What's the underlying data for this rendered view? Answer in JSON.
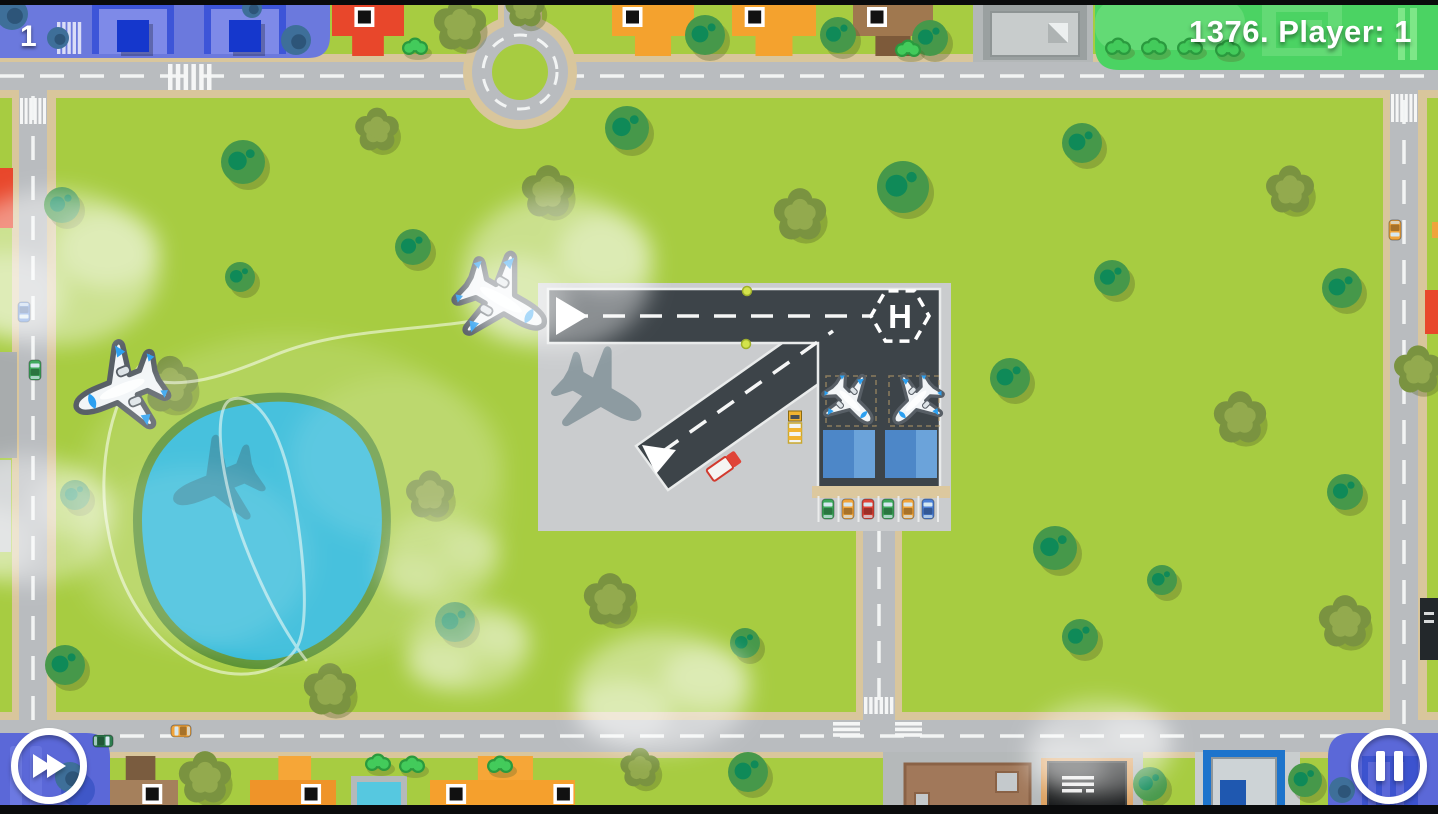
{
  "hud": {
    "level": "1",
    "score_text": "1376. Player: 1",
    "fast_forward_label": "Fast forward",
    "pause_label": "Pause"
  },
  "airport": {
    "helipad_letter": "H"
  },
  "palette": {
    "grass": "#a7cc41",
    "park_green": "#4bd363",
    "road": "#b9bcbf",
    "road_edge": "#d9c69c",
    "runway": "#3d4449",
    "apron": "#caccce",
    "lake": "#29b7d7",
    "lake_edge": "#578f2e",
    "blue_zone": "#6b79dd",
    "panel_blue": "#5b68d8",
    "hangar": "#4d87c8",
    "hangar_light": "#6ba3da",
    "tree_green": "#46984a",
    "tree_blob": "#0f8a58",
    "olive": "#7a9340",
    "olive_light": "#93aa4e",
    "bush_dark": "#2a9a3e",
    "bush_light": "#43cb5b",
    "teal_tree": "#3e6f99",
    "teal_blob": "#2d5579",
    "plane_body": "#f2f5f7",
    "plane_accent": "#2b9ff0",
    "plane_outline": "#585f66",
    "hud_text": "#ffffff"
  },
  "scene": {
    "flying_planes": [
      {
        "x": 120,
        "y": 390,
        "rot": 248,
        "scale": 1.2
      },
      {
        "x": 503,
        "y": 301,
        "rot": 120,
        "scale": 1.2
      }
    ],
    "parked_planes": [
      {
        "x": 851,
        "y": 402,
        "rot": 135,
        "scale": 0.72
      },
      {
        "x": 915,
        "y": 402,
        "rot": 225,
        "scale": 0.72
      }
    ],
    "shadow_offset": {
      "dx": 97,
      "dy": 93
    },
    "flight_paths": [
      "M 505,315 C 430,332 345,326 275,355 C 232,373 196,386 162,382",
      "M 150,355 C 110,390 96,470 108,530 C 118,590 150,640 195,663 C 240,685 285,672 298,645 C 312,615 300,520 288,470 C 272,410 248,392 230,400 C 212,410 220,480 245,545 C 268,605 292,642 306,660"
    ],
    "waypoint_dots": [
      {
        "x": 747,
        "y": 291
      },
      {
        "x": 746,
        "y": 344
      }
    ],
    "trees": [
      {
        "t": "A",
        "x": 243,
        "y": 162,
        "r": 22
      },
      {
        "t": "A",
        "x": 627,
        "y": 128,
        "r": 22
      },
      {
        "t": "A",
        "x": 903,
        "y": 187,
        "r": 26
      },
      {
        "t": "A",
        "x": 1082,
        "y": 143,
        "r": 20
      },
      {
        "t": "A",
        "x": 1112,
        "y": 278,
        "r": 18
      },
      {
        "t": "A",
        "x": 1342,
        "y": 288,
        "r": 20
      },
      {
        "t": "A",
        "x": 240,
        "y": 277,
        "r": 15
      },
      {
        "t": "A",
        "x": 413,
        "y": 247,
        "r": 18
      },
      {
        "t": "A",
        "x": 62,
        "y": 205,
        "r": 18
      },
      {
        "t": "A",
        "x": 75,
        "y": 495,
        "r": 15
      },
      {
        "t": "A",
        "x": 65,
        "y": 665,
        "r": 20
      },
      {
        "t": "A",
        "x": 455,
        "y": 622,
        "r": 20
      },
      {
        "t": "A",
        "x": 745,
        "y": 643,
        "r": 15
      },
      {
        "t": "A",
        "x": 1010,
        "y": 378,
        "r": 20
      },
      {
        "t": "A",
        "x": 1055,
        "y": 548,
        "r": 22
      },
      {
        "t": "A",
        "x": 1162,
        "y": 580,
        "r": 15
      },
      {
        "t": "A",
        "x": 1080,
        "y": 637,
        "r": 18
      },
      {
        "t": "A",
        "x": 1345,
        "y": 492,
        "r": 18
      },
      {
        "t": "A",
        "x": 930,
        "y": 38,
        "r": 18
      },
      {
        "t": "A",
        "x": 838,
        "y": 35,
        "r": 18
      },
      {
        "t": "A",
        "x": 705,
        "y": 35,
        "r": 20
      },
      {
        "t": "A",
        "x": 748,
        "y": 772,
        "r": 20
      },
      {
        "t": "A",
        "x": 1150,
        "y": 784,
        "r": 17
      },
      {
        "t": "A",
        "x": 1305,
        "y": 780,
        "r": 17
      },
      {
        "t": "B",
        "x": 377,
        "y": 130,
        "r": 20
      },
      {
        "t": "B",
        "x": 548,
        "y": 192,
        "r": 24
      },
      {
        "t": "B",
        "x": 800,
        "y": 215,
        "r": 24
      },
      {
        "t": "B",
        "x": 1290,
        "y": 190,
        "r": 22
      },
      {
        "t": "B",
        "x": 170,
        "y": 385,
        "r": 26
      },
      {
        "t": "B",
        "x": 430,
        "y": 495,
        "r": 22
      },
      {
        "t": "B",
        "x": 610,
        "y": 600,
        "r": 24
      },
      {
        "t": "B",
        "x": 330,
        "y": 690,
        "r": 24
      },
      {
        "t": "B",
        "x": 1240,
        "y": 418,
        "r": 24
      },
      {
        "t": "B",
        "x": 1345,
        "y": 622,
        "r": 24
      },
      {
        "t": "B",
        "x": 1418,
        "y": 370,
        "r": 22
      },
      {
        "t": "B",
        "x": 460,
        "y": 25,
        "r": 24
      },
      {
        "t": "B",
        "x": 525,
        "y": 8,
        "r": 18
      },
      {
        "t": "B",
        "x": 205,
        "y": 778,
        "r": 24
      },
      {
        "t": "B",
        "x": 640,
        "y": 768,
        "r": 18
      },
      {
        "t": "D",
        "x": 12,
        "y": 14,
        "r": 16
      },
      {
        "t": "D",
        "x": 58,
        "y": 38,
        "r": 11
      },
      {
        "t": "D",
        "x": 296,
        "y": 40,
        "r": 15
      },
      {
        "t": "D",
        "x": 252,
        "y": 8,
        "r": 10
      },
      {
        "t": "D",
        "x": 70,
        "y": 777,
        "r": 15
      },
      {
        "t": "D",
        "x": 1342,
        "y": 790,
        "r": 13
      }
    ],
    "bushes": [
      {
        "x": 415,
        "y": 48
      },
      {
        "x": 908,
        "y": 50
      },
      {
        "x": 1118,
        "y": 48
      },
      {
        "x": 1154,
        "y": 48
      },
      {
        "x": 1190,
        "y": 48
      },
      {
        "x": 1228,
        "y": 50
      },
      {
        "x": 378,
        "y": 764
      },
      {
        "x": 412,
        "y": 766
      },
      {
        "x": 500,
        "y": 766
      }
    ],
    "clouds": [
      {
        "x": 290,
        "y": 500,
        "rx": 215,
        "ry": 165,
        "o": 0.14
      },
      {
        "x": 55,
        "y": 268,
        "rx": 105,
        "ry": 78,
        "o": 0.42
      },
      {
        "x": 558,
        "y": 272,
        "rx": 95,
        "ry": 78,
        "o": 0.4
      },
      {
        "x": 468,
        "y": 648,
        "rx": 62,
        "ry": 45,
        "o": 0.35
      },
      {
        "x": 662,
        "y": 692,
        "rx": 88,
        "ry": 60,
        "o": 0.4
      },
      {
        "x": 1100,
        "y": 748,
        "rx": 72,
        "ry": 48,
        "o": 0.38
      },
      {
        "x": 28,
        "y": 520,
        "rx": 85,
        "ry": 65,
        "o": 0.35
      },
      {
        "x": 440,
        "y": 560,
        "rx": 60,
        "ry": 45,
        "o": 0.25
      }
    ],
    "parked_cars": {
      "y": 509,
      "xs": [
        828,
        848,
        868,
        888,
        908,
        928
      ],
      "colors": [
        "#3da85c",
        "#f0a43c",
        "#e04438",
        "#3da85c",
        "#f0a43c",
        "#4a7fd6"
      ]
    },
    "road_cars": [
      {
        "x": 24,
        "y": 312,
        "rot": 180,
        "c": "#4a7fd6"
      },
      {
        "x": 35,
        "y": 370,
        "rot": 0,
        "c": "#3da85c"
      },
      {
        "x": 1395,
        "y": 230,
        "rot": 180,
        "c": "#f0a43c"
      },
      {
        "x": 181,
        "y": 731,
        "rot": 270,
        "c": "#f0a43c"
      },
      {
        "x": 103,
        "y": 741,
        "rot": 90,
        "c": "#2e7d4f"
      }
    ],
    "houses_top": [
      {
        "x": 332,
        "w": 72,
        "color": "#e8472b",
        "chimney_f": 0.45
      },
      {
        "x": 612,
        "w": 82,
        "color": "#f4a22e",
        "chimney_f": 0.25
      },
      {
        "x": 732,
        "w": 84,
        "color": "#f4a22e",
        "chimney_f": 0.27
      },
      {
        "x": 853,
        "w": 80,
        "color": "#a0784f",
        "tab": "#7d5a3a",
        "chimney_f": 0.3
      }
    ],
    "houses_bottom": [
      {
        "x": 100,
        "w": 78,
        "color": "#a5805c",
        "tab": "#7a5c3f",
        "chimneys": [
          0.67
        ]
      },
      {
        "x": 250,
        "w": 86,
        "color": "#ef9429",
        "tab": "#f6a637",
        "chimneys": [
          0.71
        ]
      },
      {
        "x": 430,
        "w": 145,
        "color": "#f5a02d",
        "tab": "#f6a637",
        "chimneys": [
          0.18,
          0.92
        ]
      }
    ]
  }
}
